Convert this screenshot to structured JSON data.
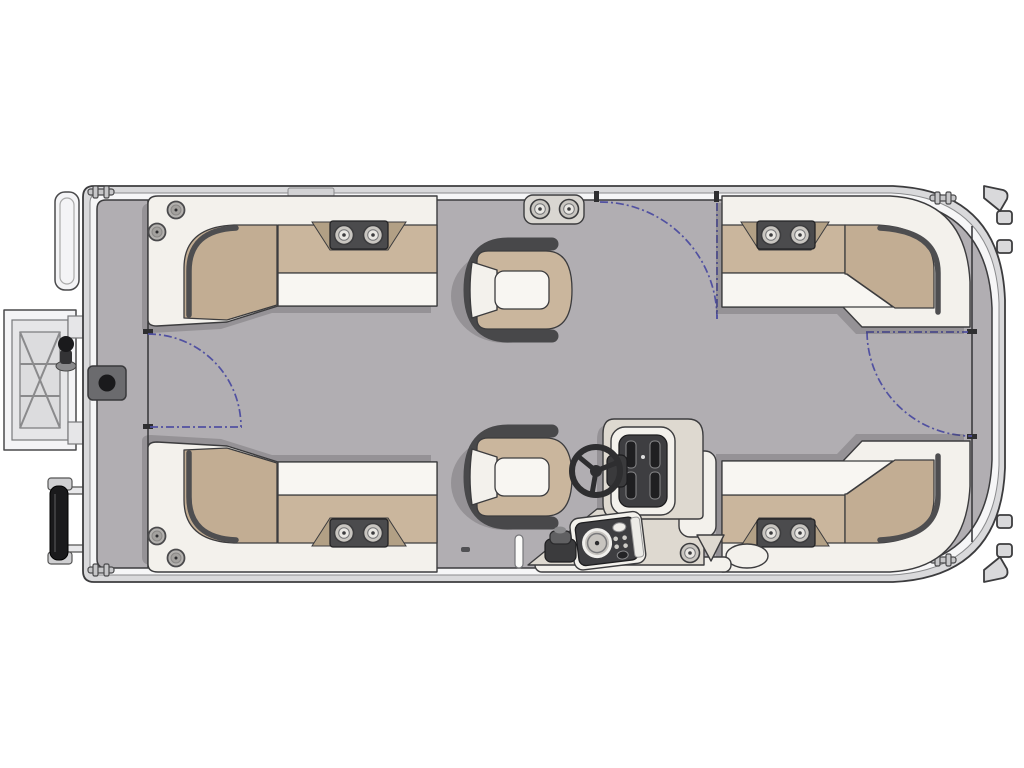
{
  "title": "Pontoon boat floor plan - overhead view",
  "colors": {
    "page_bg": "#ffffff",
    "line": "#3c3c3e",
    "hull_band": "#d9d9db",
    "rail_white": "#f6f6f7",
    "deck": "#b1aeb2",
    "seat_white": "#f3f1ec",
    "cushion_white": "#f8f6f2",
    "tan": "#cab69d",
    "tan_deep": "#c2ad93",
    "trim": "#4e4e50",
    "bracket": "#4b4b4d",
    "chair_dark": "#48484a",
    "console": "#ded9d0",
    "panel_dark": "#3e3e41",
    "wheel": "#2e2e30",
    "gate": "#5151a1",
    "metal": "#c9c6c1",
    "black": "#1a1a1c",
    "wing": "#b2a085",
    "shadow": "rgba(50,48,52,0.22)"
  },
  "elements": {
    "lounge_count": 4,
    "captain_chair_count": 2,
    "gate_count": 3,
    "cleat_count": 4,
    "cup_holder_pods": 5,
    "speaker_count": 4,
    "features": [
      "stern boarding ladder",
      "stern pedestal base",
      "motor mount",
      "helm console with steering wheel",
      "gauge pod",
      "bow nose cone fins",
      "gate swing arcs"
    ]
  }
}
